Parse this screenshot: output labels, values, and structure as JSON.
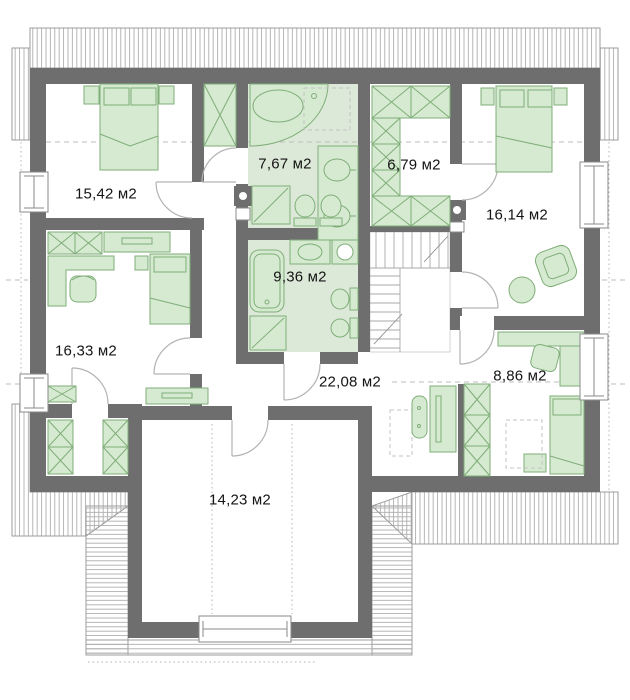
{
  "title": "Attic floor plan",
  "units_suffix": "м2",
  "rooms": [
    {
      "name": "bedroom-top-left",
      "area_label": "15,42 м2"
    },
    {
      "name": "bathroom-top",
      "area_label": "7,67 м2"
    },
    {
      "name": "wardrobe-room",
      "area_label": "6,79 м2"
    },
    {
      "name": "bedroom-top-right",
      "area_label": "16,14 м2"
    },
    {
      "name": "bathroom-middle",
      "area_label": "9,36 м2"
    },
    {
      "name": "bedroom-left",
      "area_label": "16,33 м2"
    },
    {
      "name": "hall",
      "area_label": "22,08 м2"
    },
    {
      "name": "bedroom-bottom-right",
      "area_label": "8,86 м2"
    },
    {
      "name": "room-bottom",
      "area_label": "14,23 м2"
    }
  ],
  "colors": {
    "wall": "#6e6e6e",
    "furniture_fill": "#d6e9d1",
    "furniture_stroke": "#7fae78",
    "bath_floor": "#dde9d8",
    "roof_hatch": "#aeaeae",
    "label_text": "#141414"
  }
}
